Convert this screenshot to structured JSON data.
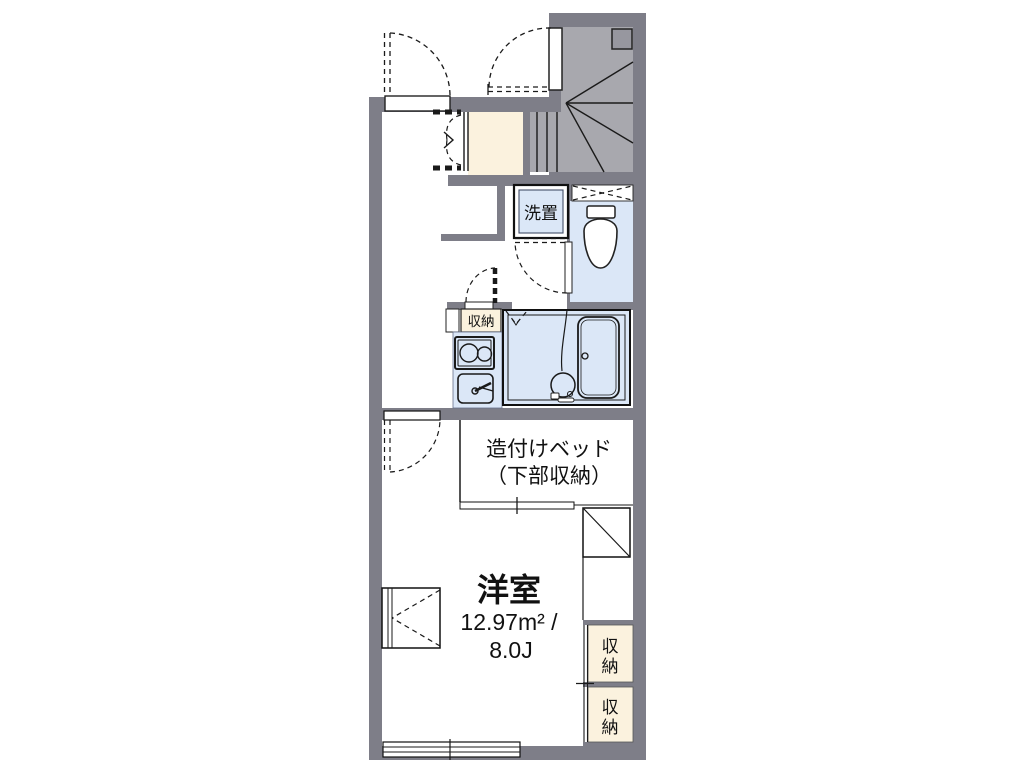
{
  "floor_plan": {
    "labels": {
      "washer_place": "洗置",
      "hall_storage": "収納",
      "built_in_bed": {
        "line1": "造付けベッド",
        "line2": "（下部収納）"
      },
      "main_room": {
        "name": "洋室",
        "area": "12.97m² /",
        "size": "8.0J"
      },
      "closet_upper": {
        "top": "収",
        "bottom": "納"
      },
      "closet_lower": {
        "top": "収",
        "bottom": "納"
      }
    },
    "colors": {
      "wall": "#7e7e88",
      "stair_floor": "#a8a8ae",
      "stair_square": "#97979f",
      "water_area": "#dbe7f7",
      "wood_floor": "#fbf2de"
    }
  }
}
